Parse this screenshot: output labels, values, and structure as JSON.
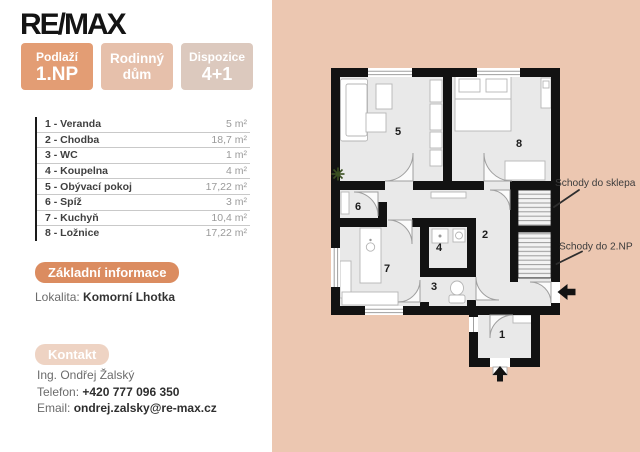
{
  "logo": {
    "text": "RE/MAX"
  },
  "badges": [
    {
      "label": "Podlaží",
      "value": "1.NP"
    },
    {
      "label": "Rodinný",
      "value": "dům"
    },
    {
      "label": "Dispozice",
      "value": "4+1"
    }
  ],
  "rooms": [
    {
      "name": "1 - Veranda",
      "area": "5 m²"
    },
    {
      "name": "2 - Chodba",
      "area": "18,7 m²"
    },
    {
      "name": "3 - WC",
      "area": "1 m²"
    },
    {
      "name": "4 - Koupelna",
      "area": "4 m²"
    },
    {
      "name": "5 - Obývací pokoj",
      "area": "17,22 m²"
    },
    {
      "name": "6 - Spíž",
      "area": "3 m²"
    },
    {
      "name": "7 - Kuchyň",
      "area": "10,4 m²"
    },
    {
      "name": "8 - Ložnice",
      "area": "17,22 m²"
    }
  ],
  "basic_info": {
    "heading": "Základní informace",
    "locality_label": "Lokalita:",
    "locality_value": "Komorní Lhotka"
  },
  "contact": {
    "heading": "Kontakt",
    "name": "Ing. Ondřej Žalský",
    "phone_label": "Telefon:",
    "phone": "+420 777 096 350",
    "email_label": "Email:",
    "email": "ondrej.zalsky@re-max.cz"
  },
  "plan": {
    "room_numbers": {
      "r1": "1",
      "r2": "2",
      "r3": "3",
      "r4": "4",
      "r5": "5",
      "r6": "6",
      "r7": "7",
      "r8": "8"
    },
    "annotations": {
      "basement": "Schody do sklepa",
      "upper_floor": "Schody do 2.NP"
    }
  },
  "colors": {
    "panel_peach": "#ecc7b1",
    "badge_orange": "#e39d74",
    "badge_light": "#e6c0ab",
    "badge_pale": "#dcc9be",
    "section_orange": "#db8c60",
    "section_pale": "#eed3c3",
    "wall_black": "#121212",
    "floor_gray": "#e9e9e9"
  }
}
